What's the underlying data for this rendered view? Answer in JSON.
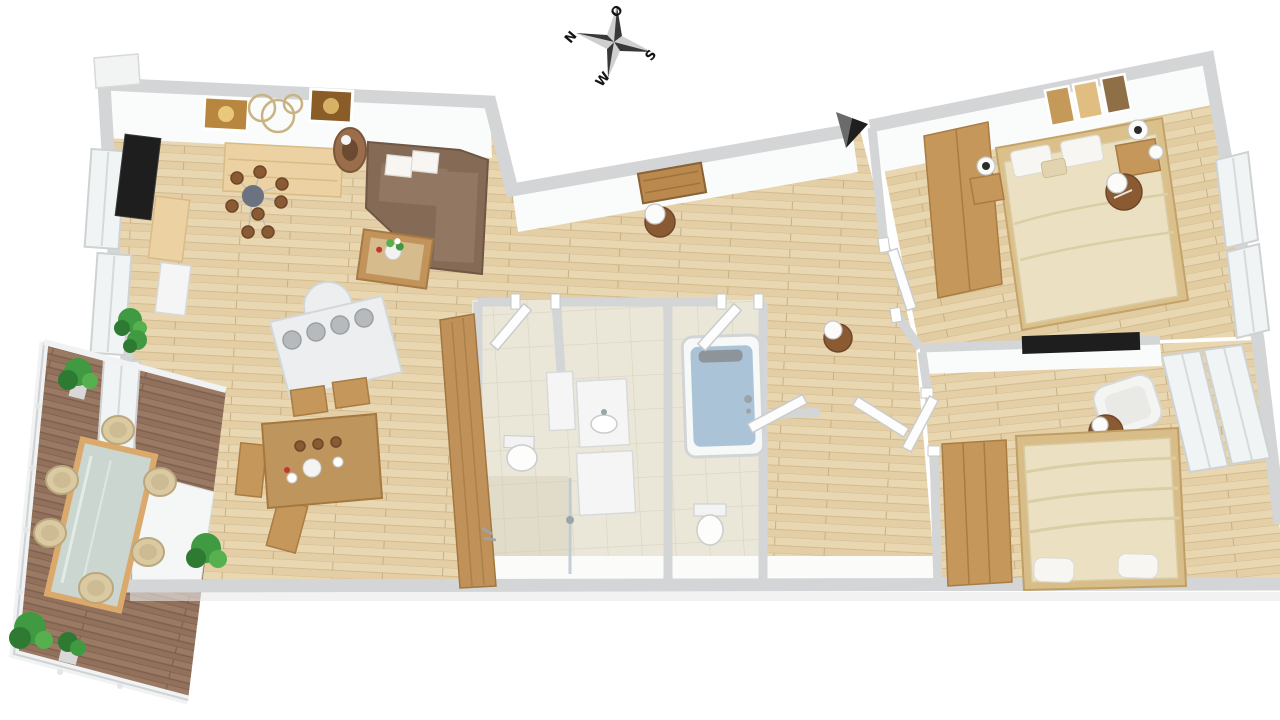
{
  "meta": {
    "description": "3D rendered top-down floor plan of an apartment with living room, open kitchen-dining area, two bathrooms, hallway, two bedrooms and a wooden terrace",
    "render_style": "3d-birdseye-floorplan"
  },
  "compass": {
    "north": "N",
    "east": "O",
    "south": "S",
    "west": "W"
  },
  "colors": {
    "wall": "#d3d5d6",
    "wallFace": "#fafbfb",
    "woodFloor": "#e9d7b2",
    "woodFloorLine": "#d3bb8e",
    "deck": "#9b7a64",
    "deckLine": "#7c5f4e",
    "tile": "#ebe7d8",
    "tileLine": "#d9d3bf",
    "furnitureWood": "#c6975b",
    "furnitureWoodDark": "#a97c42",
    "lightWood": "#ecd2a2",
    "sofa": "#856a55",
    "cushion": "#dcc9a6",
    "bedding": "#ebe1c2",
    "beddingLine": "#d9cba2",
    "offWhite": "#f4f5f4",
    "dark": "#1e1e1e",
    "water": "#abc3d6",
    "plant": "#3f9a41",
    "plantDark": "#2e7a33",
    "wicker": "#dbc9a1",
    "glass": "#ccd6d0",
    "brownLamp": "#8a5a33",
    "compassDark": "#383838",
    "compassLight": "#cfcfcf",
    "entranceArrow": "#1f1f1f"
  },
  "rooms": {
    "living_room": {
      "items": [
        "tv",
        "tv-lowboard",
        "white-cabinet",
        "sideboard",
        "wall-pictures",
        "decor-rings",
        "floor-lamp",
        "corner-sofa",
        "cushions",
        "coffee-table",
        "flower-vase",
        "chandelier",
        "potted-plants"
      ]
    },
    "kitchen_dining": {
      "items": [
        "cooktop-counter-4-burners",
        "dining-table",
        "dining-chairs-4",
        "tall-wood-cabinet",
        "tableware"
      ]
    },
    "hallway": {
      "items": [
        "entrance-door-arrow",
        "wall-picture",
        "pendant-lamps",
        "open-doors"
      ]
    },
    "bathroom_shower": {
      "items": [
        "vanity-counter",
        "washbasin",
        "toilet",
        "shower",
        "small-cabinet"
      ]
    },
    "bathroom_tub": {
      "items": [
        "bathtub-with-water",
        "toilet"
      ]
    },
    "bedroom_master": {
      "items": [
        "double-bed",
        "pillows",
        "wardrobe",
        "nightstands-2",
        "table-lamps",
        "pendant-lamp",
        "wall-panels-3",
        "corner-windows"
      ]
    },
    "bedroom_second": {
      "items": [
        "double-bed",
        "pillows",
        "wardrobe",
        "tv",
        "armchair",
        "round-side-table",
        "corner-windows"
      ]
    },
    "terrace": {
      "items": [
        "wood-deck",
        "glass-dining-table",
        "wicker-chairs-6",
        "potted-plants-4",
        "white-railing"
      ]
    }
  }
}
